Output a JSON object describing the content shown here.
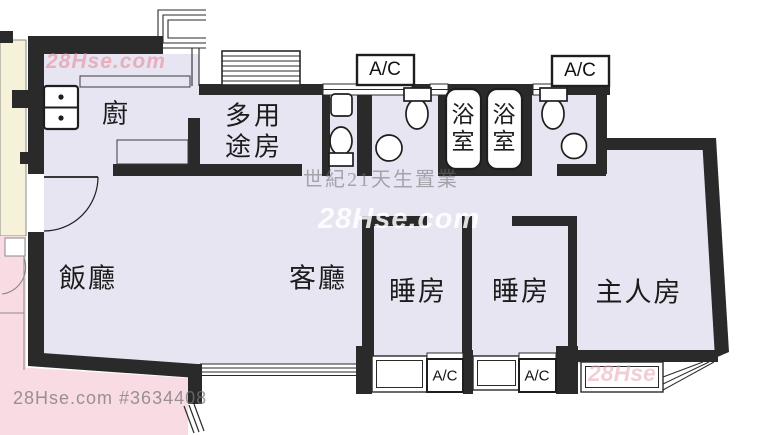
{
  "meta": {
    "type": "apartment-floor-plan",
    "colors": {
      "floor": "#e7e5f1",
      "wall": "#2a2a2a",
      "neighbor_pink": "#f9dce3",
      "neighbor_cream": "#f6f2da",
      "watermark_pink": "#e9a4b5",
      "watermark_gray": "#8f8f8f"
    }
  },
  "rooms": {
    "kitchen": "廚",
    "multipurpose_line1": "多用",
    "multipurpose_line2": "途房",
    "dining": "飯廳",
    "living": "客廳",
    "bedroom1": "睡房",
    "bedroom2": "睡房",
    "master": "主人房",
    "bathroom": "浴室"
  },
  "labels": {
    "ac": "A/C"
  },
  "watermarks": {
    "brand_top": "28Hse.com",
    "agency": "世紀21天生置業",
    "brand_center": "28Hse.com",
    "listing": "28Hse.com #3634408",
    "brand_bay": "28Hse"
  }
}
